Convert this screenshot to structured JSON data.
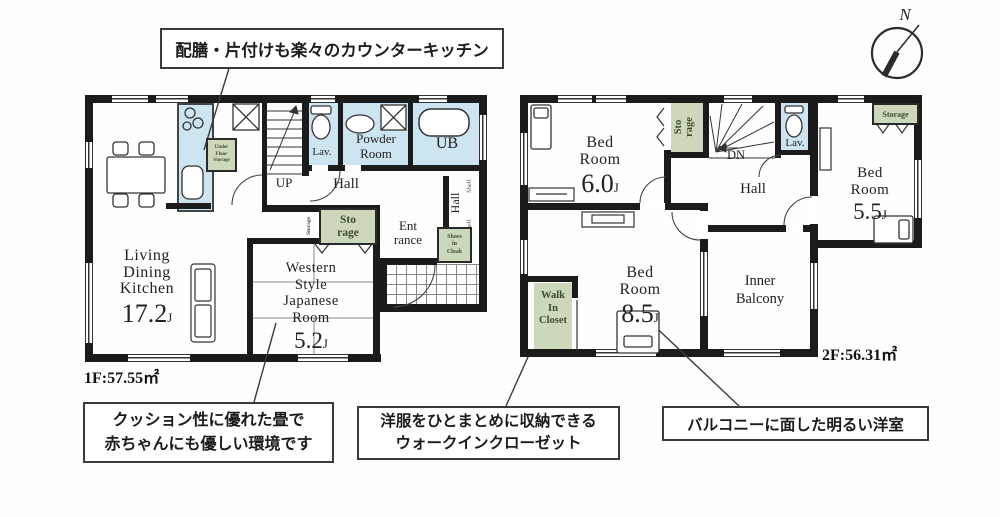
{
  "annotations": {
    "kitchen": "配膳・片付けも楽々のカウンターキッチン",
    "tatami": "クッション性に優れた畳で\n赤ちゃんにも優しい環境です",
    "wic": "洋服をひとまとめに収納できる\nウォークインクローゼット",
    "balcony": "バルコニーに面した明るい洋室"
  },
  "compass": {
    "north": "N"
  },
  "floor1": {
    "area": "1F:57.55㎡",
    "ldk": {
      "name": "Living\nDining\nKitchen",
      "size": "17.2",
      "unit": "J"
    },
    "japanese_room": {
      "name": "Western\nStyle\nJapanese\nRoom",
      "size": "5.2",
      "unit": "J"
    },
    "up": "UP",
    "hall": "Hall",
    "hall2": "Hall",
    "lav": "Lav.",
    "powder": "Powder\nRoom",
    "ub": "UB",
    "storage": "Sto\nrage",
    "storage_side": "Storage",
    "underfloor": "Under\nFloor\nStorage",
    "entrance": "Ent\nrance",
    "shoes": "Shoes\nin\nCloak",
    "shelf": "Shelf"
  },
  "floor2": {
    "area": "2F:56.31㎡",
    "bed1": {
      "name": "Bed\nRoom",
      "size": "6.0",
      "unit": "J"
    },
    "bed2": {
      "name": "Bed\nRoom",
      "size": "5.5",
      "unit": "J"
    },
    "bed3": {
      "name": "Bed\nRoom",
      "size": "8.5",
      "unit": "J"
    },
    "storage_stairs": "Sto\nrage",
    "storage_top": "Storage",
    "dn": "DN",
    "hall": "Hall",
    "lav": "Lav.",
    "wic": "Walk\nIn\nCloset",
    "inner_balcony": "Inner\nBalcony"
  }
}
